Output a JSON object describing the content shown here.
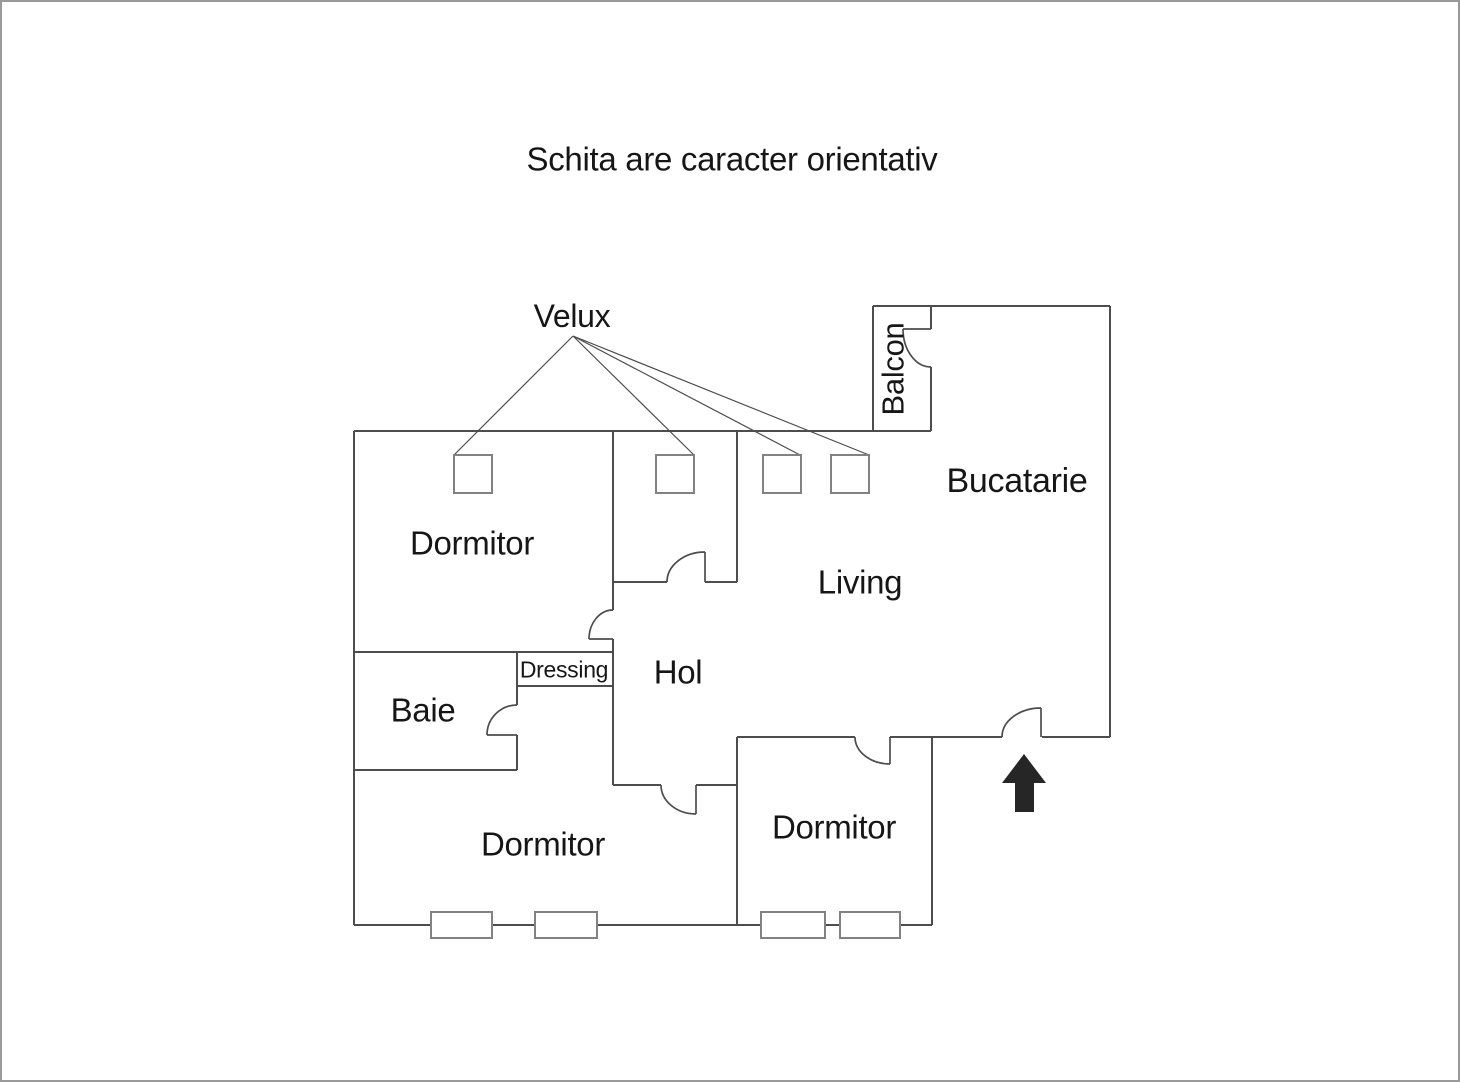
{
  "page": {
    "title": "Schita are caracter orientativ",
    "background_color": "#ffffff",
    "border_color": "#9a9a9a"
  },
  "floor_plan": {
    "colors": {
      "wall": "#4d4d4d",
      "window_outline": "#828282",
      "text": "#161616",
      "entrance_arrow": "#262626"
    },
    "labels": {
      "velux": "Velux",
      "balcon": "Balcon",
      "bucatarie": "Bucatarie",
      "living": "Living",
      "hol": "Hol",
      "dressing": "Dressing",
      "baie": "Baie",
      "dormitor_top_left": "Dormitor",
      "dormitor_bottom_left": "Dormitor",
      "dormitor_bottom_right": "Dormitor"
    },
    "velux_skylight_count": 4,
    "window_count": 4,
    "door_count": 7
  }
}
